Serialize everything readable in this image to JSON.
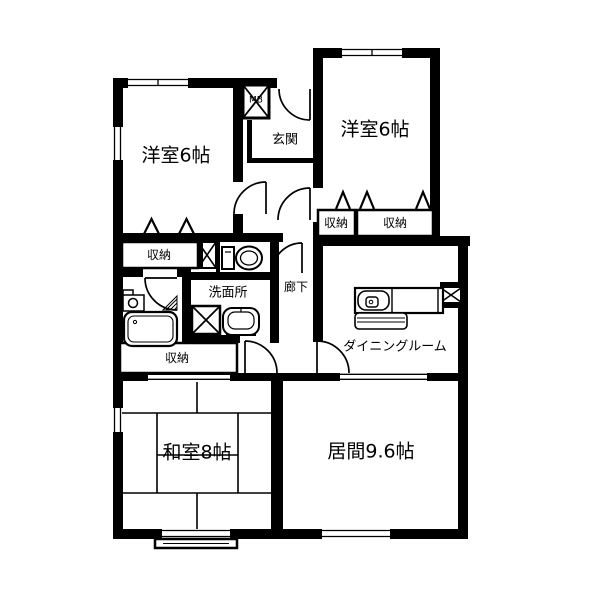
{
  "document": {
    "type": "apartment-floor-plan"
  },
  "colors": {
    "background": "#ffffff",
    "line": "#000000"
  },
  "rooms": {
    "bedroom_nw": {
      "label": "洋室6帖"
    },
    "bedroom_ne": {
      "label": "洋室6帖"
    },
    "entrance": {
      "label": "玄関"
    },
    "meter_box": {
      "label": "MB"
    },
    "closet_nw": {
      "label": "収納"
    },
    "closet_ne_left": {
      "label": "収納"
    },
    "closet_ne_right": {
      "label": "収納"
    },
    "closet_mid": {
      "label": "収納"
    },
    "washroom": {
      "label": "洗面所"
    },
    "hallway": {
      "label": "廊下"
    },
    "dining": {
      "label": "ダイニングルーム"
    },
    "japanese_room": {
      "label": "和室8帖"
    },
    "living": {
      "label": "居間9.6帖"
    }
  },
  "icons": {
    "meter_box": "crossed-box-mb",
    "pipe_shaft": "crossed-box-small",
    "pipe_space": "crossed-box-ps",
    "washer_pan": "crossed-box-washer",
    "toilet": "toilet-plan-symbol",
    "bathtub": "bathtub-plan-symbol",
    "shower_mixer": "bath-faucet-symbol",
    "vanity_sink": "vanity-sink-symbol",
    "kitchen_counter": "kitchen-sink-counter-symbol"
  }
}
